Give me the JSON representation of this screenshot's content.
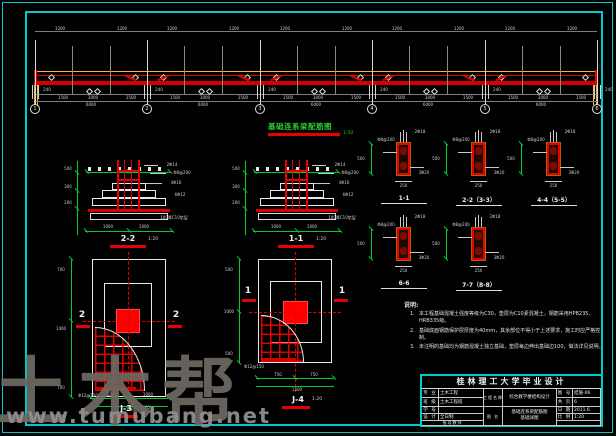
{
  "watermark": {
    "brand": "土木帮",
    "url": "www.tumubang.net"
  },
  "beam": {
    "title": "基础连系梁配筋图",
    "scale": "1:50",
    "axis_labels": [
      "1",
      "2",
      "3",
      "4",
      "5",
      "6"
    ],
    "top_dim": "1200",
    "support_dim": "240",
    "mid_dims": [
      "1500",
      "3000",
      "1500"
    ],
    "span_dim": "6000"
  },
  "foundation_sections": [
    {
      "label": "2-2",
      "scale": "1:20",
      "bottom_dims": [
        "1000",
        "1000"
      ],
      "side_dims": [
        "500",
        "300",
        "200"
      ],
      "callouts": [
        "2Φ14",
        "Φ8@200",
        "4Φ16",
        "6Φ12",
        "100厚C10垫层"
      ]
    },
    {
      "label": "1-1",
      "scale": "1:20",
      "bottom_dims": [
        "1000",
        "1000"
      ],
      "side_dims": [
        "500",
        "300",
        "200"
      ],
      "callouts": [
        "2Φ14",
        "Φ8@200",
        "4Φ16",
        "6Φ12",
        "100厚C10垫层"
      ]
    }
  ],
  "plans": [
    {
      "label": "J-3",
      "scale": "1:20",
      "section_mark": "2",
      "bottom_dims": [
        "1000",
        "1000"
      ],
      "total_dim": "2000",
      "side_dims": [
        "700",
        "1400",
        "700"
      ],
      "rebar_note": "Φ12@150"
    },
    {
      "label": "J-4",
      "scale": "1:20",
      "section_mark": "1",
      "bottom_dims": [
        "750",
        "750"
      ],
      "total_dim": "1500",
      "side_dims": [
        "500",
        "1000",
        "500"
      ],
      "rebar_note": "Φ12@150"
    }
  ],
  "beam_sections": {
    "labels": [
      "1-1",
      "2-2（3-3）",
      "4-4（5-5）",
      "6-6",
      "7-7（8-8）"
    ],
    "width_dim": "250",
    "height_dim": "500",
    "top_callout": "2Φ18",
    "bottom_callout": "3Φ20",
    "stirrup": "Φ8@200"
  },
  "notes": {
    "heading": "说明:",
    "items": [
      "本工程基础混凝土强度等级为C30，垫层为C10素混凝土，钢筋采用HPB235、HRB335级。",
      "基础底面钢筋保护层厚度为40mm，其余部位不得小于上述要求，施工时应严格控制。",
      "未注明的基础均为钢筋混凝土独立基础，垫层每边伸出基础边100，做法详见说明。"
    ]
  },
  "titleblock": {
    "school": "桂林理工大学毕业设计",
    "rows_left": [
      {
        "label": "专 业",
        "value": "土木工程"
      },
      {
        "label": "班 级",
        "value": "土木工程班"
      },
      {
        "label": "学 号",
        "value": ""
      },
      {
        "label": "设 计",
        "value": "全日制"
      }
    ],
    "tutor_label": "指导教师",
    "project_label": "工程名称",
    "project_name": "综合教学楼结构设计",
    "drawing_label": "图 名",
    "drawing_title_1": "基础连系梁配筋图",
    "drawing_title_2": "基础详图",
    "rows_right": [
      {
        "label": "图 号",
        "value": "结施-06"
      },
      {
        "label": "共 页",
        "value": "6"
      },
      {
        "label": "日 期",
        "value": "2011.6"
      },
      {
        "label": "比 例",
        "value": "1:20"
      }
    ]
  }
}
